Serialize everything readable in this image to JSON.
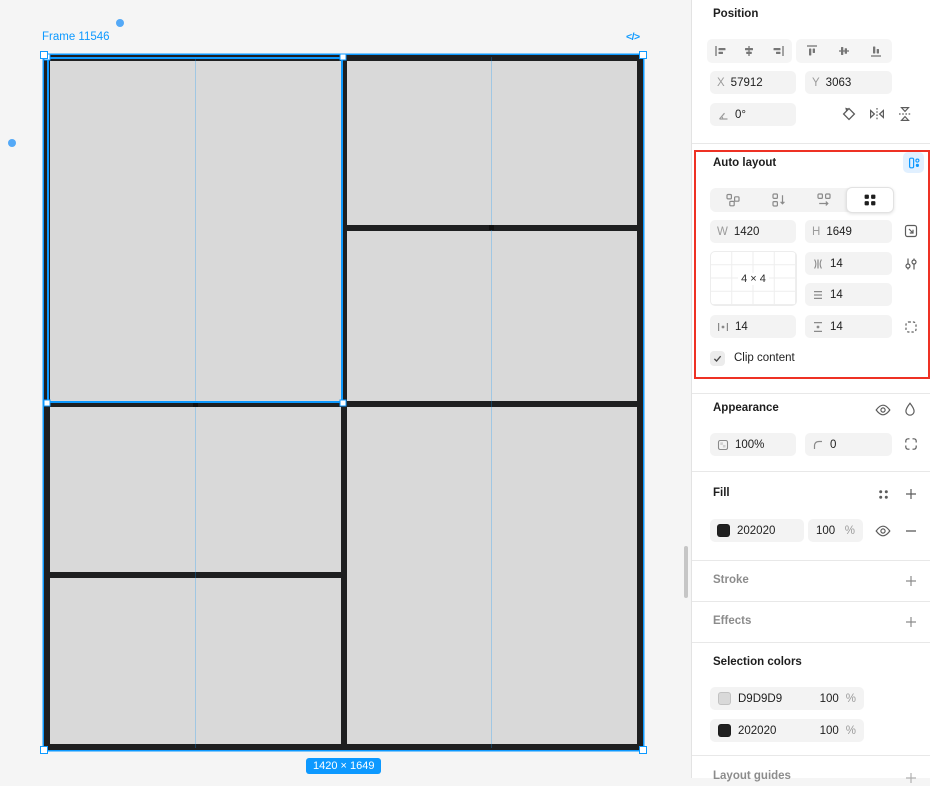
{
  "canvas": {
    "frame_label": "Frame 11546",
    "code_icon": "</>",
    "size_badge": "1420 × 1649",
    "bg_color": "#f5f5f5",
    "frame_fill": "#202020",
    "cell_fill": "#D9D9D9",
    "selection_color": "#0d99ff"
  },
  "panel": {
    "position": {
      "title": "Position",
      "x_label": "X",
      "x_value": "57912",
      "y_label": "Y",
      "y_value": "3063",
      "rotation_value": "0°"
    },
    "auto_layout": {
      "title": "Auto layout",
      "w_label": "W",
      "w_value": "1420",
      "h_label": "H",
      "h_value": "1649",
      "grid_size": "4 × 4",
      "column_gap": "14",
      "row_gap": "14",
      "padding_horizontal": "14",
      "padding_vertical": "14",
      "clip_label": "Clip content"
    },
    "appearance": {
      "title": "Appearance",
      "opacity": "100%",
      "corner_radius": "0"
    },
    "fill": {
      "title": "Fill",
      "hex": "202020",
      "opacity": "100",
      "percent": "%",
      "swatch_color": "#202020"
    },
    "stroke": {
      "title": "Stroke"
    },
    "effects": {
      "title": "Effects"
    },
    "selection_colors": {
      "title": "Selection colors",
      "rows": [
        {
          "hex": "D9D9D9",
          "opacity": "100",
          "percent": "%",
          "swatch_color": "#d9d9d9"
        },
        {
          "hex": "202020",
          "opacity": "100",
          "percent": "%",
          "swatch_color": "#202020"
        }
      ]
    },
    "layout_guides": {
      "title": "Layout guides"
    }
  },
  "annotation": {
    "color": "#ee3124"
  }
}
